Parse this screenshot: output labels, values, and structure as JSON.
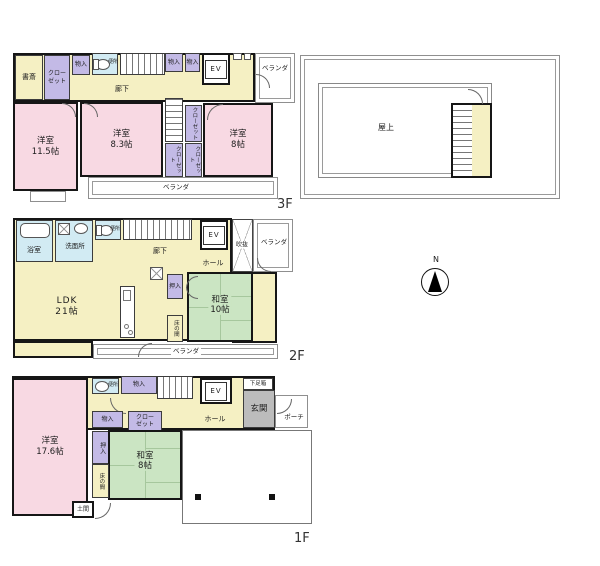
{
  "compass": {
    "label": "N"
  },
  "palette": {
    "western_room_pink": "#f8d9e3",
    "corridor_yellow": "#f5f0c3",
    "storage_purple": "#c3bae6",
    "tatami_green": "#cbe5c3",
    "wet_area_blue": "#d2ebf3",
    "entrance_gray": "#bcbcbc"
  },
  "floors": {
    "f3": {
      "floor_label": "3F",
      "rooms": {
        "shosai": "書斎",
        "closet_main": "クロー\nゼット",
        "mono_a": "物入",
        "mono_b": "物入",
        "mono_c": "物入",
        "benjo": "便所",
        "rouka": "廊下",
        "ev": "EV",
        "veranda_right": "ベランダ",
        "yoshitsu_115": "洋室\n11.5帖",
        "yoshitsu_83": "洋室\n8.3帖",
        "yoshitsu_8": "洋室\n8帖",
        "closet_tr": "クローゼット",
        "closet_bl": "クローゼット",
        "closet_br": "クローゼット",
        "veranda_bottom": "ベランダ"
      }
    },
    "roof": {
      "label": "屋上"
    },
    "f2": {
      "floor_label": "2F",
      "rooms": {
        "yokushitsu": "浴室",
        "senmenjo": "洗面所",
        "benjo": "便所",
        "rouka": "廊下",
        "ev": "EV",
        "hall": "ホール",
        "fukinuke": "吹抜",
        "veranda_right": "ベランダ",
        "ldk": "LDK\n21帖",
        "oshiire": "押入",
        "washitsu": "和室\n10帖",
        "tokonoma": "床の間",
        "veranda_bottom": "ベランダ"
      }
    },
    "f1": {
      "floor_label": "1F",
      "rooms": {
        "benjo": "便所",
        "mono_a": "物入",
        "ev": "EV",
        "getabako": "下足箱",
        "genkan": "玄関",
        "porch": "ポーチ",
        "hall": "ホール",
        "mono_b": "物入",
        "closet": "クロー\nゼット",
        "oshiire": "押入",
        "washitsu": "和室\n8帖",
        "tokonoma": "床の間",
        "yoshitsu_176": "洋室\n17.6帖",
        "doma": "土間"
      }
    }
  }
}
